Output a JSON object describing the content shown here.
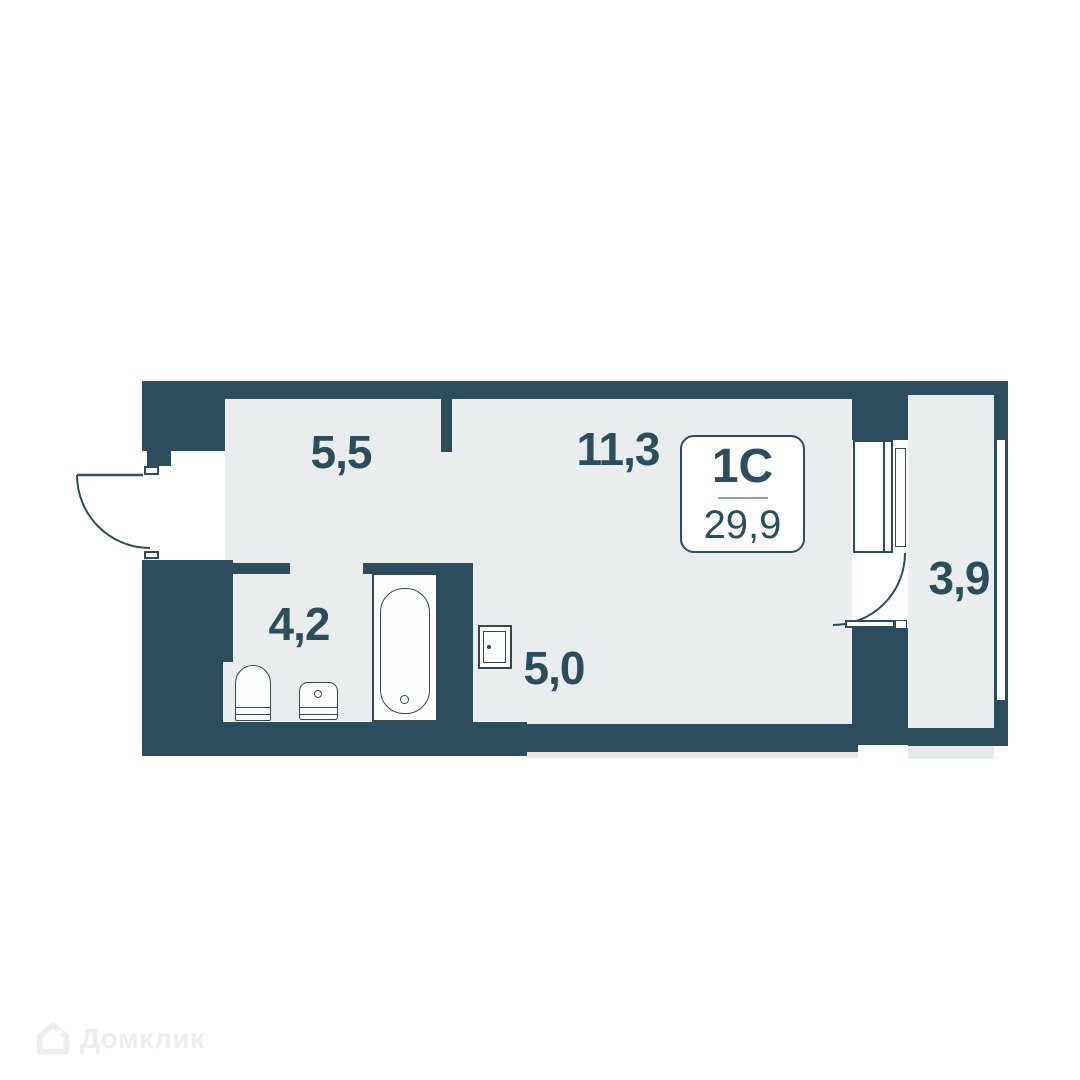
{
  "colors": {
    "wall": "#2b4d5d",
    "floor": "#eaeded",
    "label_text": "#2b4d5d",
    "watermark": "#ededed"
  },
  "plan": {
    "unit": {
      "type_label": "1С",
      "total_area": "29,9"
    },
    "rooms": [
      {
        "name": "hallway",
        "area": "5,5"
      },
      {
        "name": "living-room",
        "area": "11,3"
      },
      {
        "name": "bathroom",
        "area": "4,2"
      },
      {
        "name": "kitchen-niche",
        "area": "5,0"
      },
      {
        "name": "balcony",
        "area": "3,9"
      }
    ]
  },
  "watermark": {
    "brand": "Домклик",
    "logo": "domclick-house-icon"
  }
}
